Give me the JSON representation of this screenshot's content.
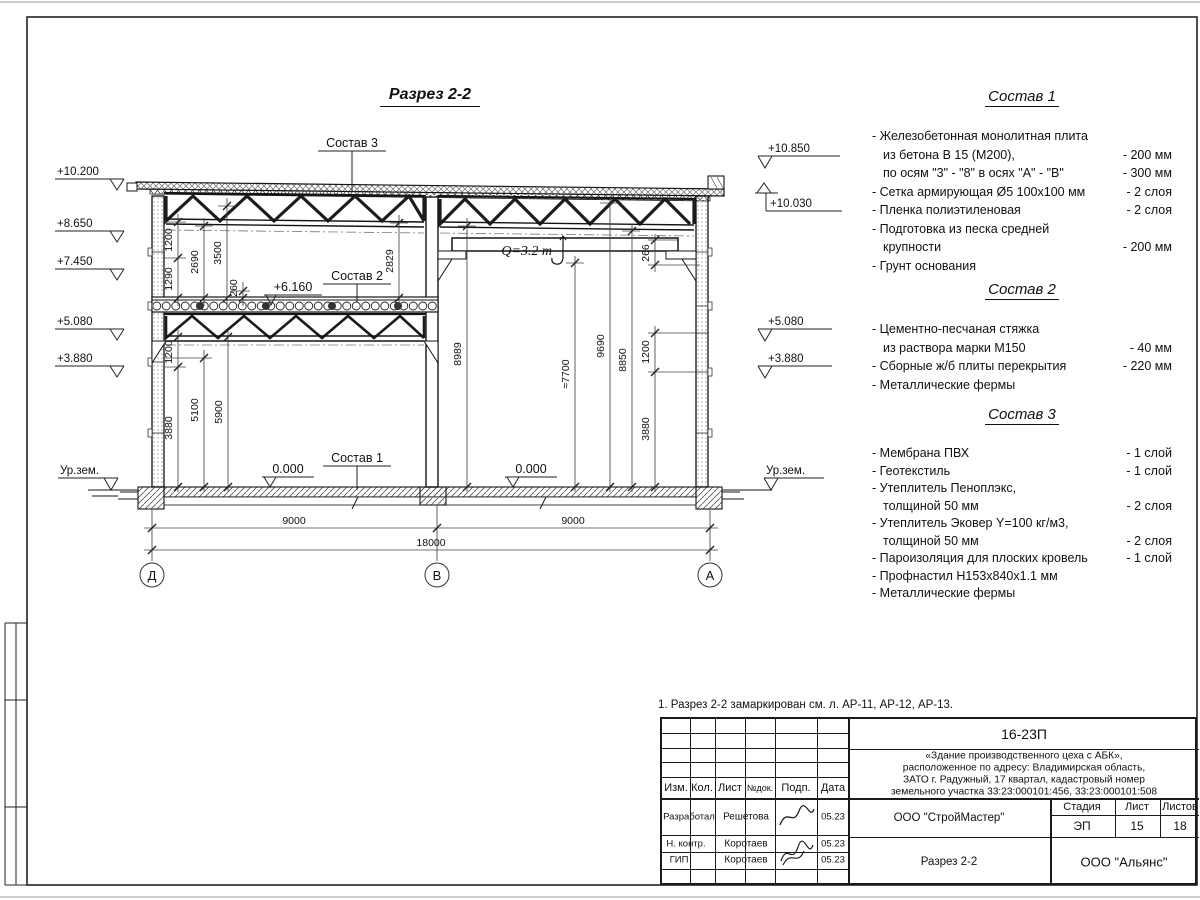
{
  "drawing": {
    "title": "Разрез 2-2",
    "callouts": {
      "sostav1": "Состав 1",
      "sostav2": "Состав 2",
      "sostav3": "Состав 3",
      "crane": "Q=3.2 т",
      "elev6160": "+6.160",
      "zero_left": "0.000",
      "zero_right": "0.000"
    },
    "elev_left": {
      "v10200": "+10.200",
      "v8650": "+8.650",
      "v7450": "+7.450",
      "v5080": "+5.080",
      "v3880": "+3.880",
      "ground": "Ур.зем."
    },
    "elev_right": {
      "v10850": "+10.850",
      "v10030": "+10.030",
      "v5080": "+5.080",
      "v3880": "+3.880",
      "ground": "Ур.зем."
    },
    "dims": {
      "ul1200": "1200",
      "ul1290": "1290",
      "ul2690": "2690",
      "ul3500": "3500",
      "ul260": "260",
      "ul2829": "2829",
      "ll1200": "1200",
      "ll3880": "3880",
      "ll5100": "5100",
      "ll5900": "5900",
      "rb266": "266",
      "rb8989": "8989",
      "rb7700": "≈7700",
      "rb9690": "9690",
      "rb8850": "8850",
      "rb1200": "1200",
      "rb3880": "3880"
    },
    "bottom": {
      "span_left": "9000",
      "span_right": "9000",
      "total": "18000"
    },
    "axes": {
      "left": "Д",
      "middle": "В",
      "right": "А"
    }
  },
  "compositions": [
    {
      "heading": "Состав 1",
      "lines": [
        {
          "text": "- Железобетонная  монолитная плита",
          "value": ""
        },
        {
          "text": "из бетона В 15 (М200),",
          "value": "- 200 мм"
        },
        {
          "text": "по осям \"3\" - \"8\" в осях \"А\" - \"В\"",
          "value": "- 300 мм"
        },
        {
          "text": "- Сетка армирующая Ø5 100х100 мм",
          "value": "- 2 слоя"
        },
        {
          "text": "- Пленка полиэтиленовая",
          "value": "- 2 слоя"
        },
        {
          "text": "- Подготовка из песка средней",
          "value": ""
        },
        {
          "text": "крупности",
          "value": "- 200 мм"
        },
        {
          "text": "- Грунт основания",
          "value": ""
        }
      ]
    },
    {
      "heading": "Состав 2",
      "lines": [
        {
          "text": "- Цементно-песчаная стяжка",
          "value": ""
        },
        {
          "text": "из раствора марки М150",
          "value": "- 40 мм"
        },
        {
          "text": "- Сборные ж/б плиты перекрытия",
          "value": "- 220 мм"
        },
        {
          "text": "- Металлические фермы",
          "value": ""
        }
      ]
    },
    {
      "heading": "Состав 3",
      "lines": [
        {
          "text": "- Мембрана ПВХ",
          "value": "- 1 слой"
        },
        {
          "text": "- Геотекстиль",
          "value": "- 1 слой"
        },
        {
          "text": "- Утеплитель Пеноплэкс,",
          "value": ""
        },
        {
          "text": "толщиной 50 мм",
          "value": "- 2 слоя"
        },
        {
          "text": "- Утеплитель Эковер Y=100 кг/м3,",
          "value": ""
        },
        {
          "text": "толщиной 50 мм",
          "value": "- 2 слоя"
        },
        {
          "text": "- Пароизоляция для плоских кровель",
          "value": "- 1 слой"
        },
        {
          "text": "- Профнастил Н153х840х1.1 мм",
          "value": ""
        },
        {
          "text": "- Металлические фермы",
          "value": ""
        }
      ]
    }
  ],
  "note": "1. Разрез 2-2 замаркирован см. л. АР-11, АР-12, АР-13.",
  "titleblock": {
    "doc_number": "16-23П",
    "description_lines": [
      "«Здание производственного цеха с АБК»,",
      "расположенное по адресу: Владимирская область,",
      "ЗАТО г. Радужный, 17 квартал, кадастровый номер",
      "земельного участка 33:23:000101:456, 33:23:000101:508"
    ],
    "col_headers": {
      "izm": "Изм.",
      "kol": "Кол.",
      "list": "Лист",
      "ndok": "№док.",
      "podp": "Подп.",
      "data": "Дата"
    },
    "rows": [
      {
        "role": "Разработал",
        "name": "Решетова",
        "date": "05.23"
      },
      {
        "role": "Н. контр.",
        "name": "Коротаев",
        "date": "05.23"
      },
      {
        "role": "ГИП",
        "name": "Коротаев",
        "date": "05.23"
      }
    ],
    "contractor": "ООО \"СтройМастер\"",
    "stage_headers": {
      "stage": "Стадия",
      "sheet": "Лист",
      "sheets": "Листов"
    },
    "stage": "ЭП",
    "sheet": "15",
    "sheets": "18",
    "sheet_title": "Разрез 2-2",
    "company": "ООО \"Альянс\""
  }
}
